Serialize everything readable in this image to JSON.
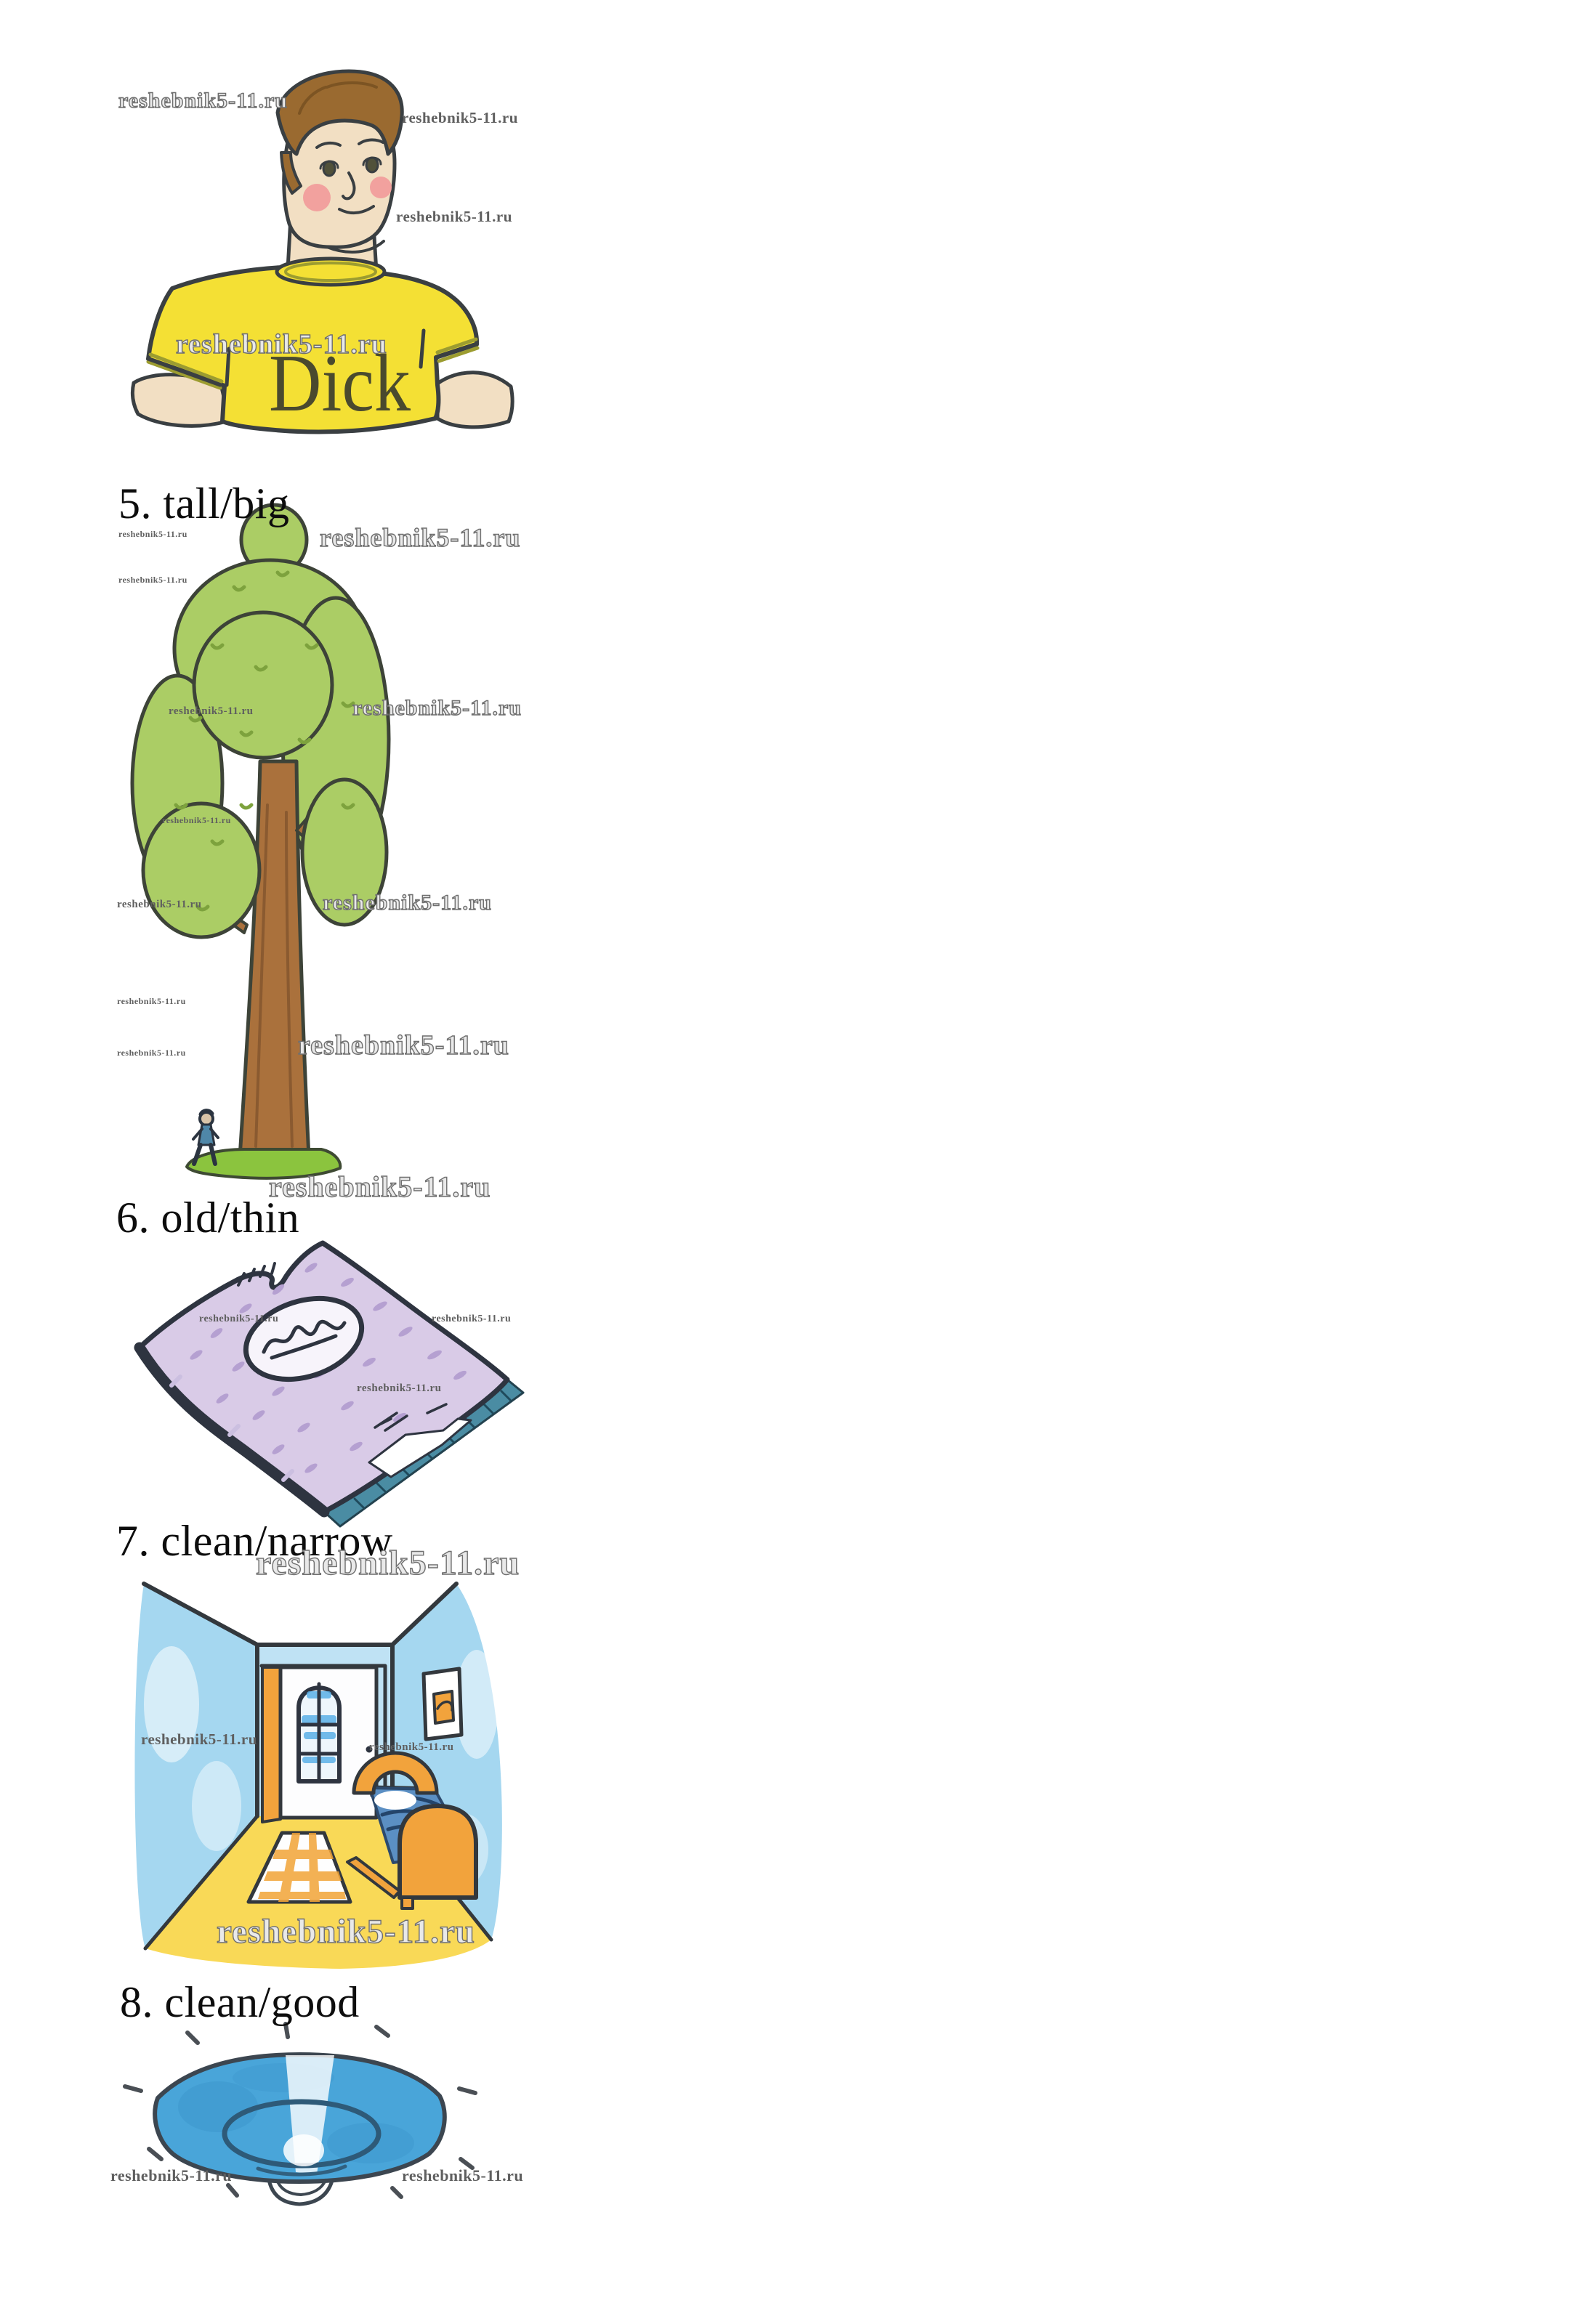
{
  "watermark_text": "reshebnik5-11.ru",
  "page": {
    "kind": "textbook exercise page with four captioned watercolor illustrations",
    "background": "#ffffff"
  },
  "items": [
    {
      "number": "5",
      "pair": "tall/big",
      "caption": "5. tall/big",
      "illustration": "boy-named-dick-in-yellow-tshirt"
    },
    {
      "number": "6",
      "pair": "old/thin",
      "caption": "6. old/thin",
      "illustration": "tall-tree-with-tiny-person"
    },
    {
      "number": "7",
      "pair": "clean/narrow",
      "caption": "7. clean/narrow",
      "illustration": "purple-spotted-book"
    },
    {
      "number": "8",
      "pair": "clean/good",
      "caption": "8. clean/good",
      "illustration": "sparkling-blue-plate"
    }
  ],
  "boy": {
    "shirt_name": "Dick"
  },
  "colors": {
    "outline": "#3a3f42",
    "caption_text": "#0d0d0d",
    "watermark_gray": "#6f6f6f",
    "boy_skin": "#f2dfc3",
    "boy_hair": "#9a6a30",
    "boy_shirt": "#f4e034",
    "boy_cheek": "#f2a19e",
    "tree_leaf": "#abcd65",
    "tree_leaf_dark": "#7da23d",
    "tree_trunk": "#aa713c",
    "grass": "#8bc43e",
    "book_cover": "#d9cbe7",
    "book_spot": "#b5a0d1",
    "book_pages": "#4a8ca3",
    "room_wall": "#a5d7f0",
    "room_floor": "#f9d957",
    "room_accent": "#f2a33c",
    "bed_blue": "#5b8fc3",
    "plate_blue": "#49a5d9"
  }
}
